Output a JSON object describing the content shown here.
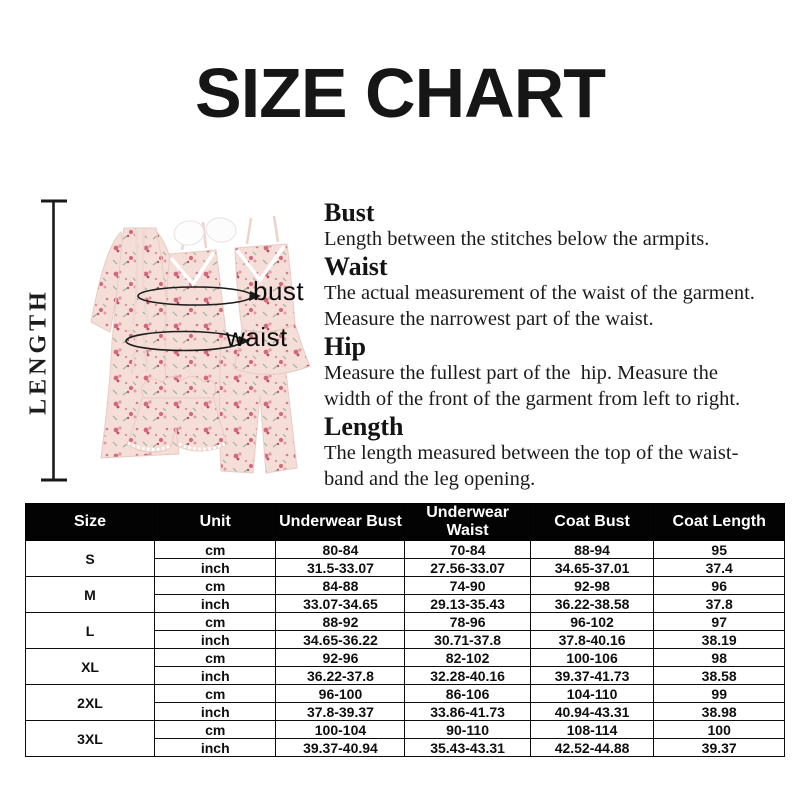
{
  "title": "SIZE CHART",
  "diagram": {
    "length_label": "LENGTH",
    "bust_label": "bust",
    "waist_label": "waist"
  },
  "definitions": [
    {
      "term": "Bust",
      "lines": [
        "Length between the stitches below the armpits."
      ]
    },
    {
      "term": "Waist",
      "lines": [
        "The actual measurement of the waist of the garment.",
        "Measure the narrowest part of the waist."
      ]
    },
    {
      "term": "Hip",
      "lines": [
        "Measure the fullest part of the  hip. Measure the",
        "width of the front of the garment from left to right."
      ]
    },
    {
      "term": "Length",
      "lines": [
        "The length measured between the top of the waist-",
        "band and the leg opening."
      ]
    }
  ],
  "size_table": {
    "headers": [
      "Size",
      "Unit",
      "Underwear Bust",
      "Underwear Waist",
      "Coat Bust",
      "Coat Length"
    ],
    "groups": [
      {
        "size": "S",
        "rows": [
          [
            "cm",
            "80-84",
            "70-84",
            "88-94",
            "95"
          ],
          [
            "inch",
            "31.5-33.07",
            "27.56-33.07",
            "34.65-37.01",
            "37.4"
          ]
        ]
      },
      {
        "size": "M",
        "rows": [
          [
            "cm",
            "84-88",
            "74-90",
            "92-98",
            "96"
          ],
          [
            "inch",
            "33.07-34.65",
            "29.13-35.43",
            "36.22-38.58",
            "37.8"
          ]
        ]
      },
      {
        "size": "L",
        "rows": [
          [
            "cm",
            "88-92",
            "78-96",
            "96-102",
            "97"
          ],
          [
            "inch",
            "34.65-36.22",
            "30.71-37.8",
            "37.8-40.16",
            "38.19"
          ]
        ]
      },
      {
        "size": "XL",
        "rows": [
          [
            "cm",
            "92-96",
            "82-102",
            "100-106",
            "98"
          ],
          [
            "inch",
            "36.22-37.8",
            "32.28-40.16",
            "39.37-41.73",
            "38.58"
          ]
        ]
      },
      {
        "size": "2XL",
        "rows": [
          [
            "cm",
            "96-100",
            "86-106",
            "104-110",
            "99"
          ],
          [
            "inch",
            "37.8-39.37",
            "33.86-41.73",
            "40.94-43.31",
            "38.98"
          ]
        ]
      },
      {
        "size": "3XL",
        "rows": [
          [
            "cm",
            "100-104",
            "90-110",
            "108-114",
            "100"
          ],
          [
            "inch",
            "39.37-40.94",
            "35.43-43.31",
            "42.52-44.88",
            "39.37"
          ]
        ]
      }
    ]
  },
  "colors": {
    "header_bg": "#030303",
    "header_text": "#ffffff",
    "table_border": "#0d0d0d",
    "text": "#151515",
    "garment_base": "#f5ded8",
    "garment_outline": "#e8cbc3",
    "floral_dark": "#c14e62",
    "floral_mid": "#d4697b",
    "floral_light": "#e49aa6",
    "leaf": "#9cb39c",
    "lace": "#ffffff"
  }
}
